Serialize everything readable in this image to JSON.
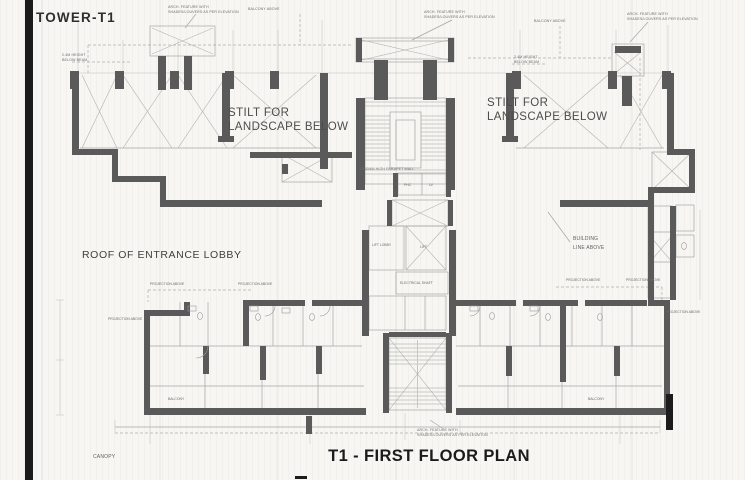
{
  "window": {
    "title": "TOWER-T1"
  },
  "plan": {
    "title": "T1 - FIRST FLOOR PLAN",
    "areas": {
      "stilt_line1": "STILT FOR",
      "stilt_line2": "LANDSCAPE BELOW",
      "roof_lobby": "ROOF OF ENTRANCE LOBBY",
      "canopy": "CANOPY"
    },
    "annotations": {
      "arch_feature_line1": "ARCH. FEATURE WITH",
      "arch_feature_line2": "SHADES/LOUVERS AS PER ELEVATION",
      "balcony_above": "BALCONY ABOVE",
      "beam_line1": "2.4M HEIGHT",
      "beam_line2": "BELOW BEAM",
      "building_line1": "BUILDING",
      "building_line2": "LINE ABOVE",
      "parapet": "1200MM HIGH PARAPET WALL",
      "projection_above": "PROJECTION ABOVE"
    },
    "core": {
      "lift_lobby": "LIFT LOBBY",
      "lift": "LIFT",
      "electrical": "ELECTRICAL SHAFT",
      "phc": "PHC",
      "lv": "LV",
      "balcony": "BALCONY"
    },
    "colors": {
      "paper": "#f7f6f2",
      "ink": "#2b2b2b",
      "wall": "#5a5a5a",
      "thin_line": "#a6a6a6",
      "scan_edge": "#141414"
    }
  }
}
